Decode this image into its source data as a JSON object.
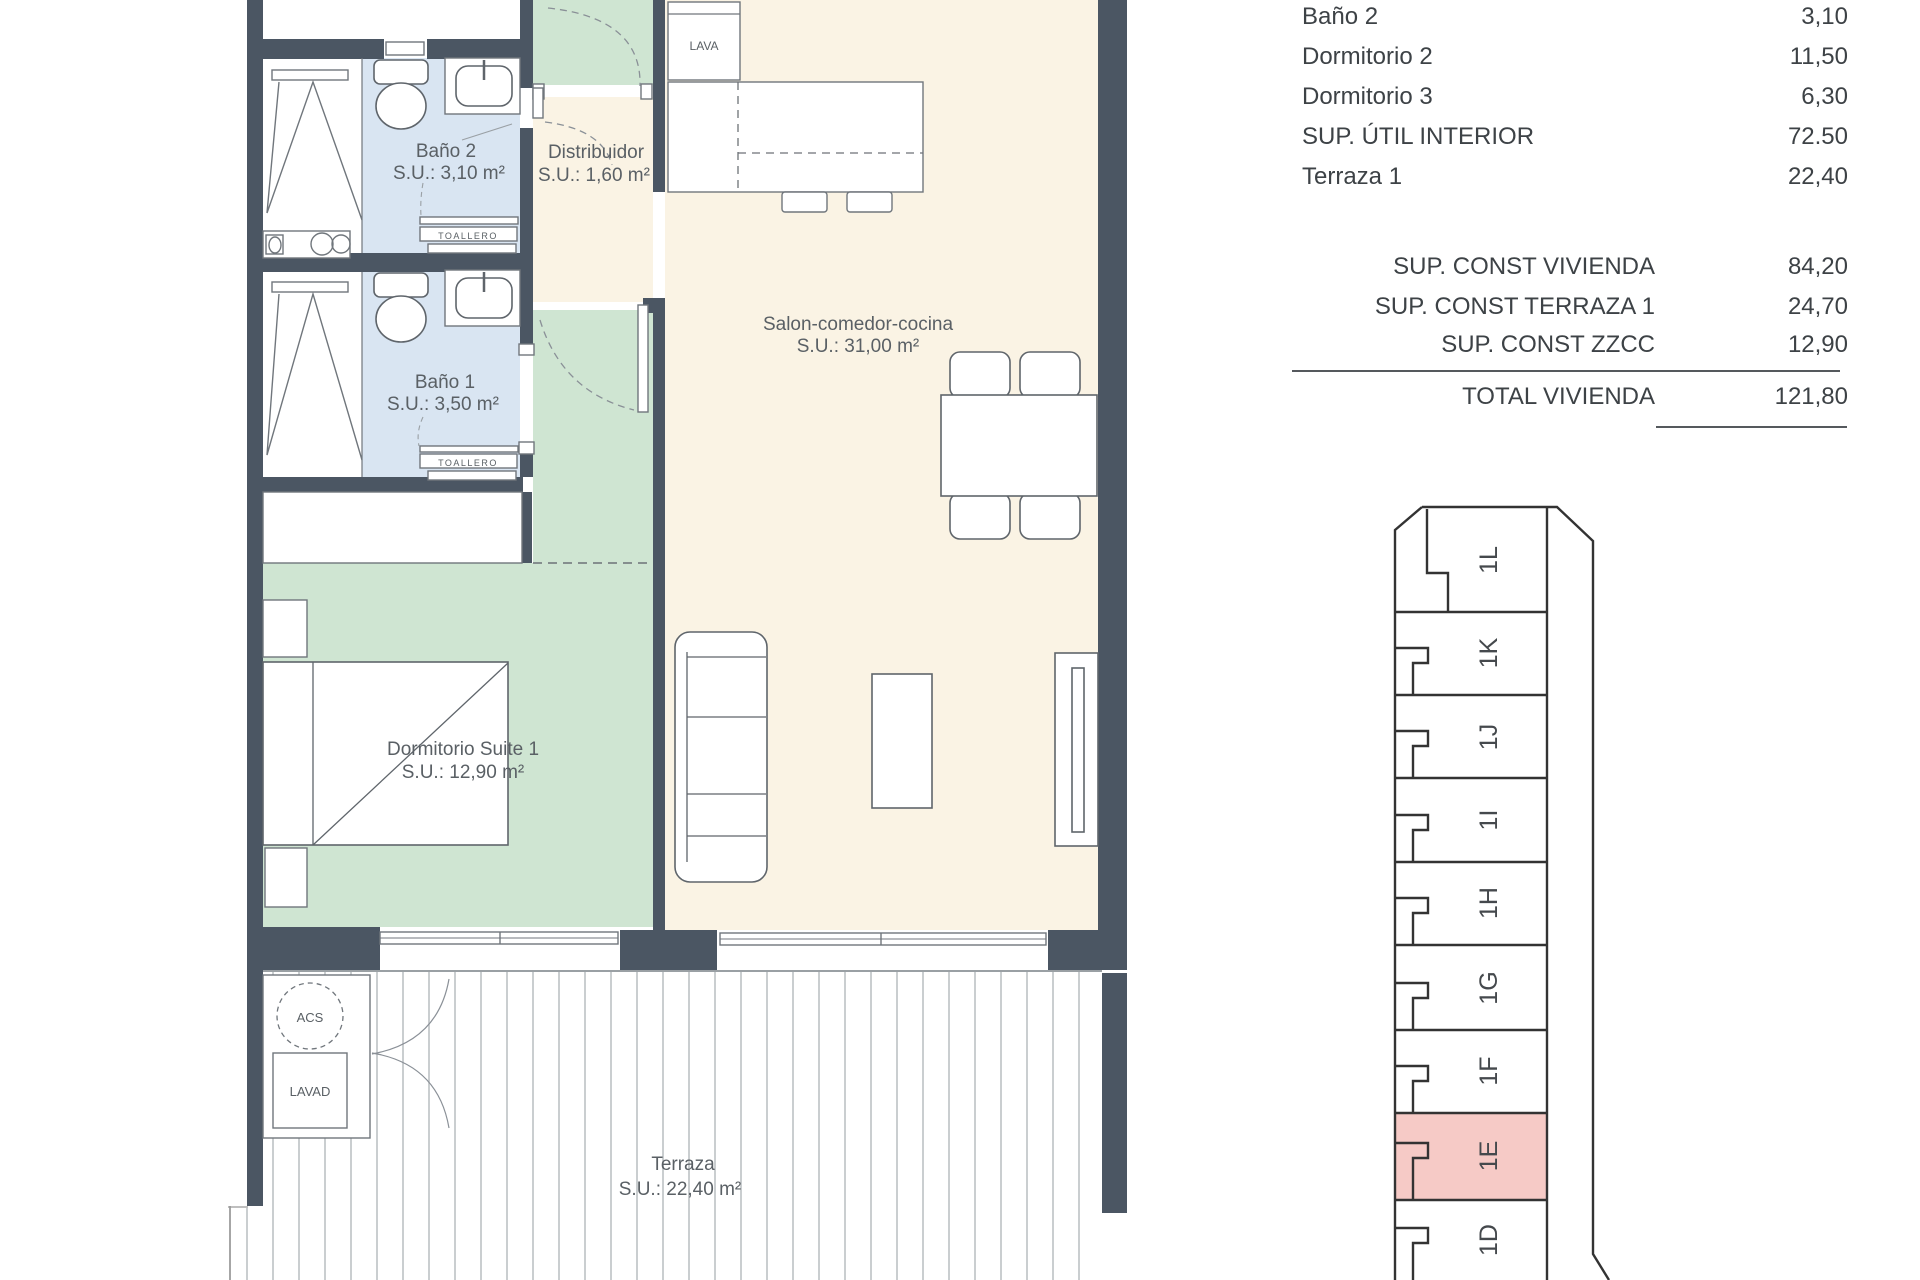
{
  "colors": {
    "wall": "#4b5663",
    "bath": "#d9e5f2",
    "bedroom": "#cfe5d2",
    "living": "#faf3e4",
    "ink": "#5a6065",
    "table_ink": "#3d4246",
    "line": "#70767c",
    "highlight": "#f6cac6",
    "deck_line": "#b9bdc0"
  },
  "plan": {
    "rooms": [
      {
        "name": "Baño 2",
        "su": "S.U.: 3,10 m²"
      },
      {
        "name": "Baño 1",
        "su": "S.U.: 3,50 m²"
      },
      {
        "name": "Distribuidor",
        "su": "S.U.: 1,60 m²"
      },
      {
        "name": "Dormitorio Suite 1",
        "su": "S.U.: 12,90 m²"
      },
      {
        "name": "Salon-comedor-cocina",
        "su": "S.U.: 31,00 m²"
      },
      {
        "name": "Terraza",
        "su": "S.U.: 22,40 m²"
      }
    ],
    "fixtures": {
      "lava": "LAVA",
      "acs": "ACS",
      "lavad": "LAVAD",
      "toallero": "TOALLERO"
    }
  },
  "surface_table": {
    "rows": [
      {
        "label": "Baño 2",
        "value": "3,10"
      },
      {
        "label": "Dormitorio 2",
        "value": "11,50"
      },
      {
        "label": "Dormitorio 3",
        "value": "6,30"
      },
      {
        "label": "SUP. ÚTIL INTERIOR",
        "value": "72.50"
      },
      {
        "label": "Terraza 1",
        "value": "22,40"
      }
    ],
    "const_rows": [
      {
        "label": "SUP. CONST VIVIENDA",
        "value": "84,20"
      },
      {
        "label": "SUP. CONST TERRAZA 1",
        "value": "24,70"
      },
      {
        "label": "SUP. CONST ZZCC",
        "value": "12,90"
      }
    ],
    "total": {
      "label": "TOTAL VIVIENDA",
      "value": "121,80"
    }
  },
  "key_plan": {
    "highlighted_unit": "1E",
    "units": [
      {
        "label": "1L"
      },
      {
        "label": "1K"
      },
      {
        "label": "1J"
      },
      {
        "label": "1I"
      },
      {
        "label": "1H"
      },
      {
        "label": "1G"
      },
      {
        "label": "1F"
      },
      {
        "label": "1E",
        "highlighted": true
      },
      {
        "label": "1D"
      }
    ]
  }
}
